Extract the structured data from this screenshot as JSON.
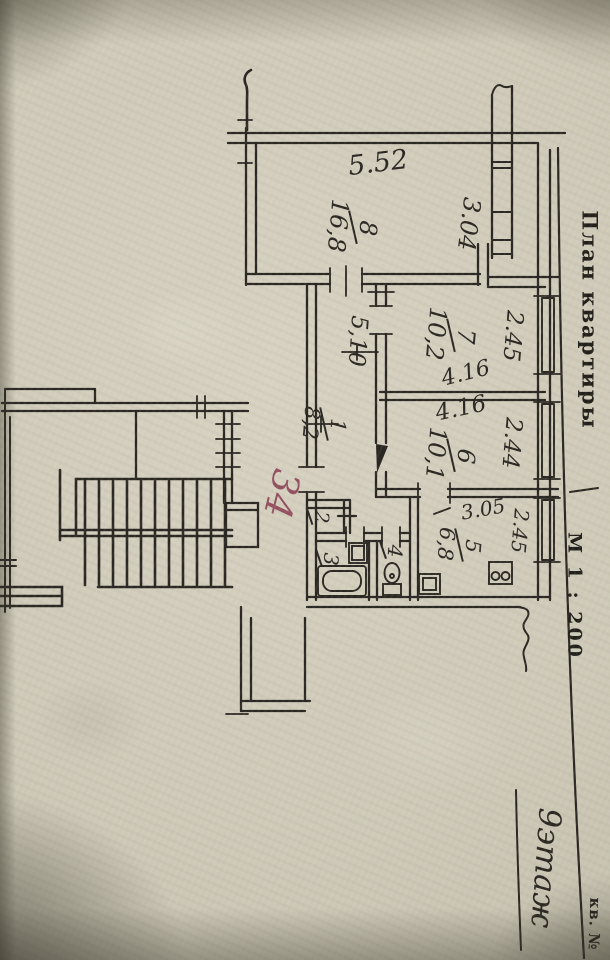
{
  "paper": {
    "background": "#cec9b7",
    "ink": "#2b2722",
    "red_ink": "#8c4054"
  },
  "margin": {
    "title": "План квартиры",
    "scale": "М 1 : 200",
    "apartment_label": "кв. №",
    "floor_note": "9этаж"
  },
  "red_note": "34",
  "rooms": {
    "r8": {
      "num": "8",
      "area": "16,8"
    },
    "r7": {
      "num": "7",
      "area": "10,2"
    },
    "r6": {
      "num": "6",
      "area": "10,1"
    },
    "r5": {
      "num": "5",
      "area": "6,8"
    },
    "r4": {
      "num": "4"
    },
    "r3": {
      "num": "3"
    },
    "r2": {
      "num": "2"
    },
    "r1": {
      "num": "1",
      "area": "8,2"
    }
  },
  "dims": {
    "top_width": "5.52",
    "balcony": "3.04",
    "room7_width": "4.16",
    "room6_width": "4.16",
    "room7_depth": "2.45",
    "room6_depth": "2.44",
    "kitchen_depth": "2.45",
    "kitchen_width": "3.05",
    "corridor_length": "5,10"
  }
}
